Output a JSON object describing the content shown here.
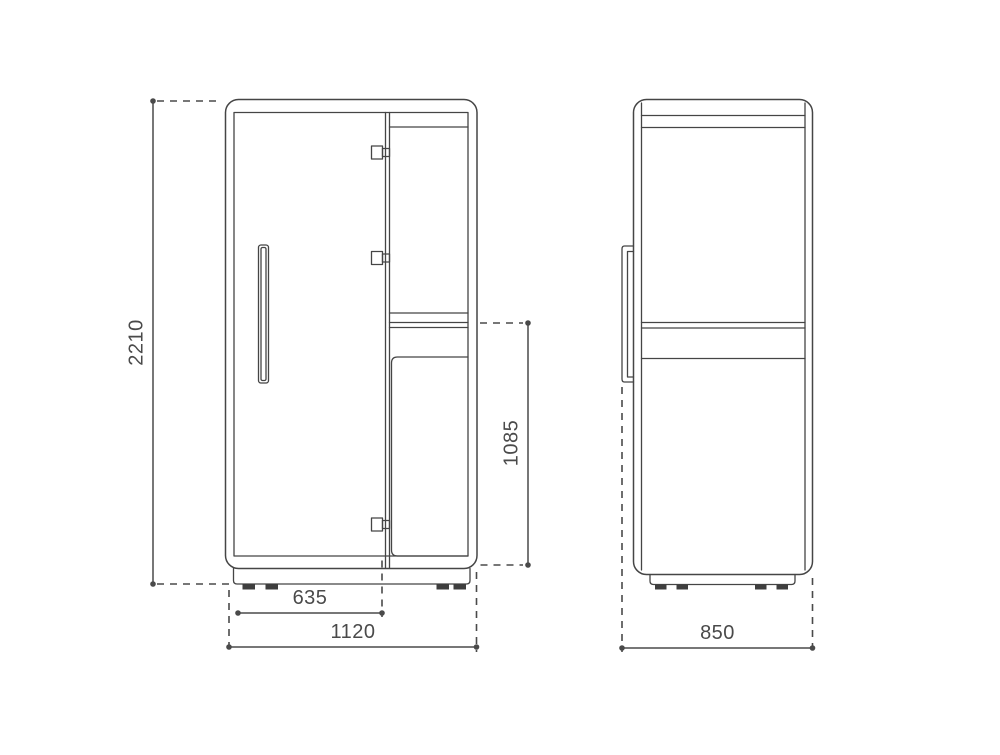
{
  "page": {
    "background_color": "#ffffff"
  },
  "drawing": {
    "type": "technical-elevation-drawing",
    "line_color": "#454545",
    "dimension_color": "#4a4a4a",
    "front_view": {
      "dimensions": {
        "overall_height": "2210",
        "door_width": "635",
        "overall_width": "1120",
        "worktop_height": "1085"
      }
    },
    "side_view": {
      "dimensions": {
        "overall_depth": "850"
      }
    }
  }
}
